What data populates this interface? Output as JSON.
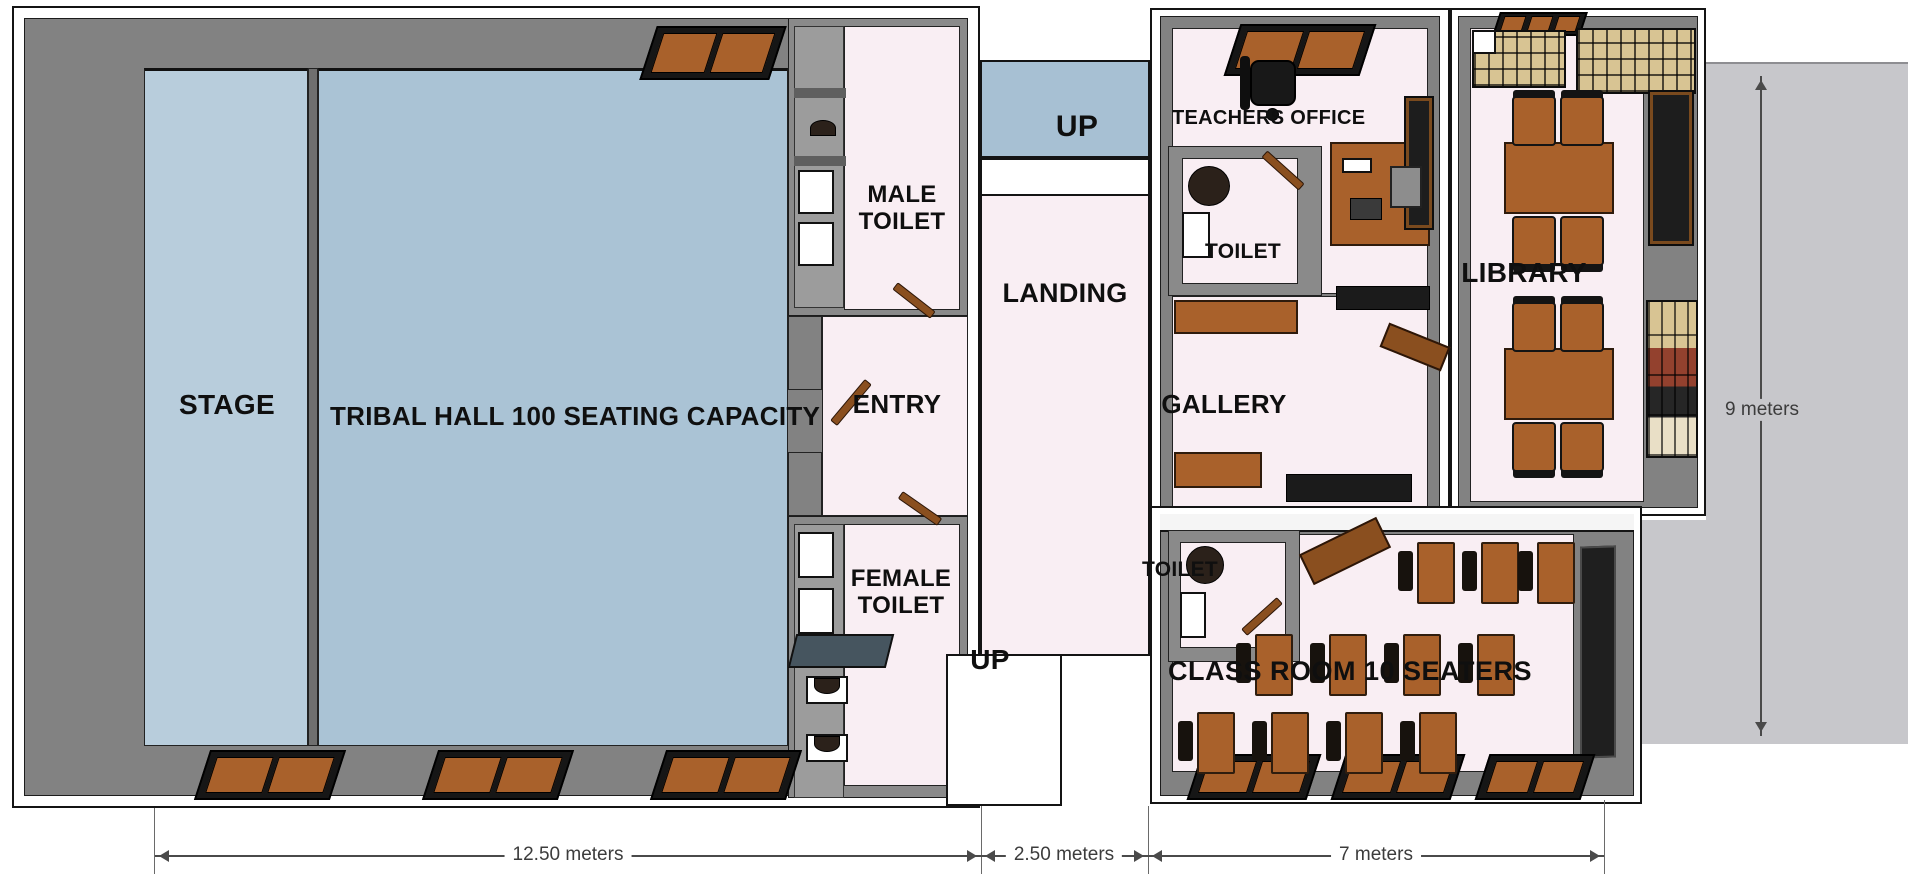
{
  "rooms": {
    "stage": {
      "label": "STAGE"
    },
    "tribal_hall": {
      "label": "TRIBAL HALL 100 SEATING CAPACITY"
    },
    "male_toilet": {
      "line1": "MALE",
      "line2": "TOILET"
    },
    "entry": {
      "label": "ENTRY"
    },
    "landing": {
      "label": "LANDING"
    },
    "female_toilet": {
      "line1": "FEMALE",
      "line2": "TOILET"
    },
    "teachers_office": {
      "label": "TEACHERS OFFICE"
    },
    "office_toilet": {
      "label": "TOILET"
    },
    "gallery": {
      "label": "GALLERY"
    },
    "library": {
      "label": "LIBRARY"
    },
    "classroom": {
      "label": "CLASS ROOM 10 SEATERS"
    },
    "classroom_toilet": {
      "label": "TOILET"
    }
  },
  "stairs": {
    "upper_label": "UP",
    "lower_label": "UP"
  },
  "dimensions": {
    "hall_width": "12.50 meters",
    "stairs_width": "2.50 meters",
    "classroom_width": "7 meters",
    "building_depth": "9 meters"
  },
  "colors": {
    "hall_floor": "#aac3d5",
    "stage_floor": "#b8cddc",
    "room_floor": "#f9eef3",
    "stair_floor": "#a7c0d3",
    "wall": "#828282",
    "wall_dark": "#6f6f6f",
    "furniture": "#a9612b",
    "door": "#8a4f1f",
    "annotation_area": "#c7c7cb",
    "line": "#4a4a4a"
  }
}
